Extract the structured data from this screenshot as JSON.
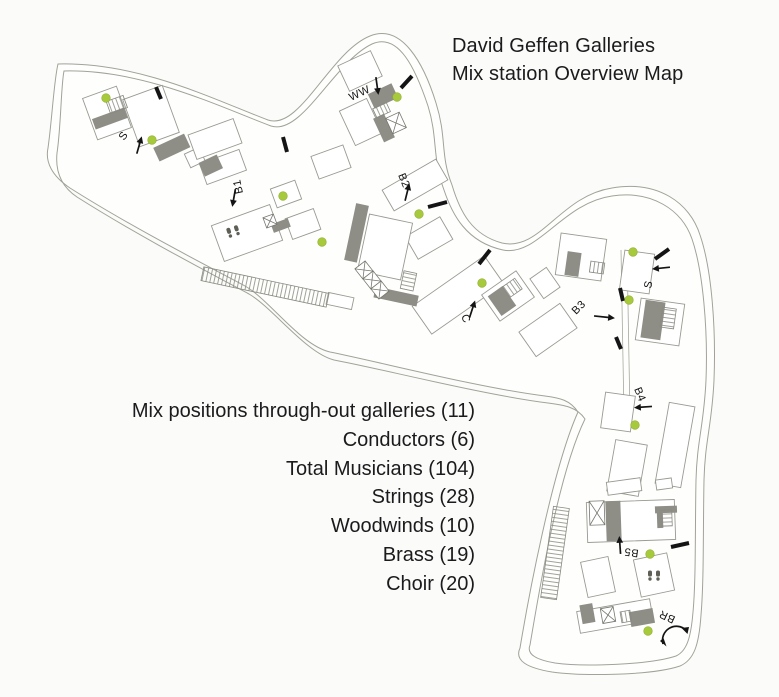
{
  "title": {
    "line1": "David Geffen Galleries",
    "line2": "Mix station Overview Map"
  },
  "stats": {
    "items": [
      "Mix positions through-out galleries (11)",
      "Conductors (6)",
      "Total Musicians (104)",
      "Strings (28)",
      "Woodwinds (10)",
      "Brass (19)",
      "Choir (20)"
    ]
  },
  "map": {
    "labels": {
      "s_left": "S",
      "b1": "B1",
      "ww": "WW",
      "b2": "B2",
      "c": "C",
      "s_right": "S",
      "b3": "B3",
      "b4": "B4",
      "b5": "B5",
      "br": "BR"
    },
    "colors": {
      "mix_dot": "#a7c93c",
      "wall_fill": "#8e8e86",
      "outline": "#a2a29a",
      "label_text": "#141414"
    },
    "icons": {
      "mix_position": "green-dot",
      "door": "black-tick",
      "stairs": "hatched-strip",
      "restroom": "person-pair",
      "rotation": "curved-double-arrow"
    }
  }
}
